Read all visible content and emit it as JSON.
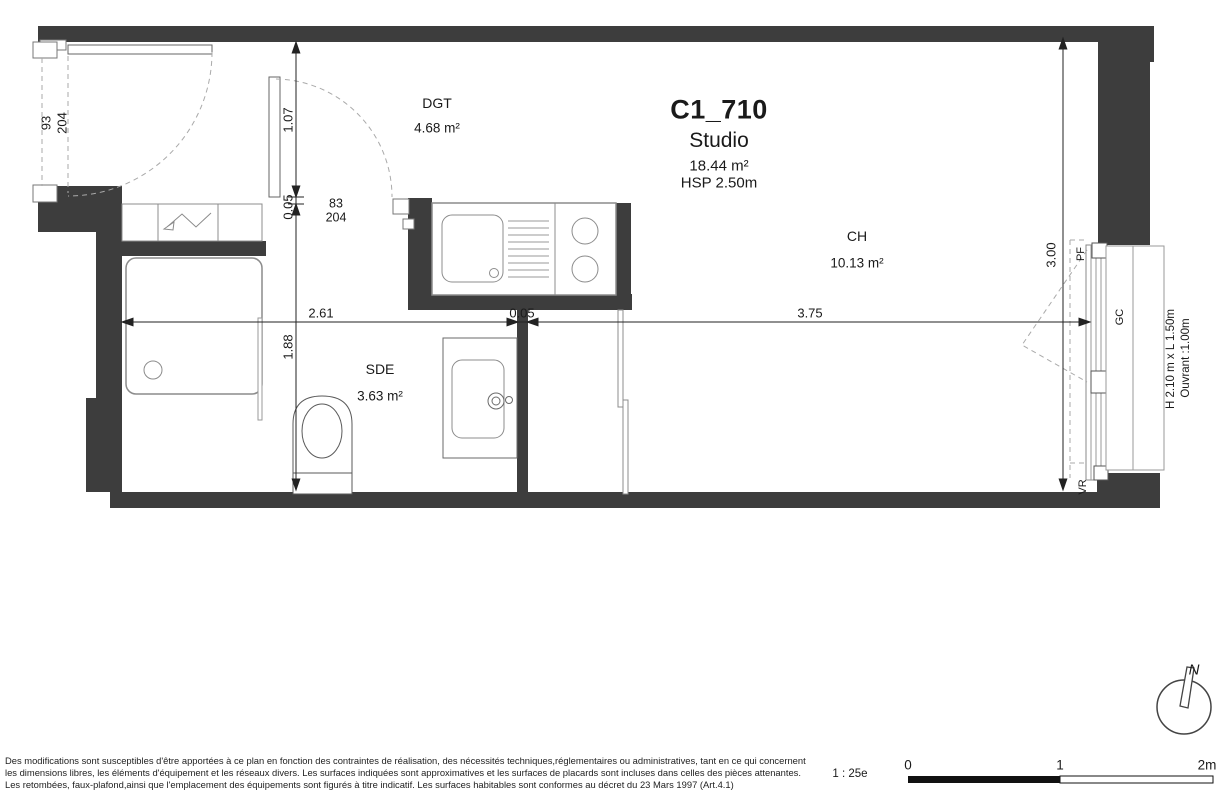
{
  "title": {
    "code": "C1_710",
    "type": "Studio",
    "area": "18.44 m²",
    "ceiling": "HSP 2.50m"
  },
  "rooms": {
    "dgt": {
      "name": "DGT",
      "area": "4.68 m²"
    },
    "sde": {
      "name": "SDE",
      "area": "3.63 m²"
    },
    "ch": {
      "name": "CH",
      "area": "10.13 m²"
    }
  },
  "dimensions": {
    "entry_height": "1.07",
    "wall_v": "0.05",
    "sde_depth": "1.88",
    "left_width": "2.61",
    "partition": "0.05",
    "ch_width": "3.75",
    "right_depth": "3.00"
  },
  "doors": {
    "entry": {
      "width": "93",
      "height": "204"
    },
    "sde": {
      "width": "83",
      "height": "204"
    }
  },
  "window": {
    "pf": "PF",
    "gc": "GC",
    "vr": "VR",
    "size": "H 2.10 m x L 1.50m",
    "opening": "Ouvrant :1.00m"
  },
  "scalebar": {
    "ratio": "1 : 25e",
    "t0": "0",
    "t1": "1",
    "t2": "2m"
  },
  "compass": {
    "north": "N"
  },
  "disclaimer": {
    "line1": "Des modifications sont susceptibles d'être apportées à ce plan en fonction des contraintes de réalisation, des nécessités techniques,réglementaires ou administratives, tant en ce qui concernent",
    "line2": "les dimensions libres, les éléments d'équipement et les réseaux divers. Les surfaces indiquées sont approximatives et les surfaces de placards sont incluses dans celles des pièces attenantes.",
    "line3": "Les retombées, faux-plafond,ainsi que l'emplacement des équipements sont figurés à titre indicatif. Les surfaces habitables sont conformes au décret du 23 Mars 1997 (Art.4.1)"
  }
}
